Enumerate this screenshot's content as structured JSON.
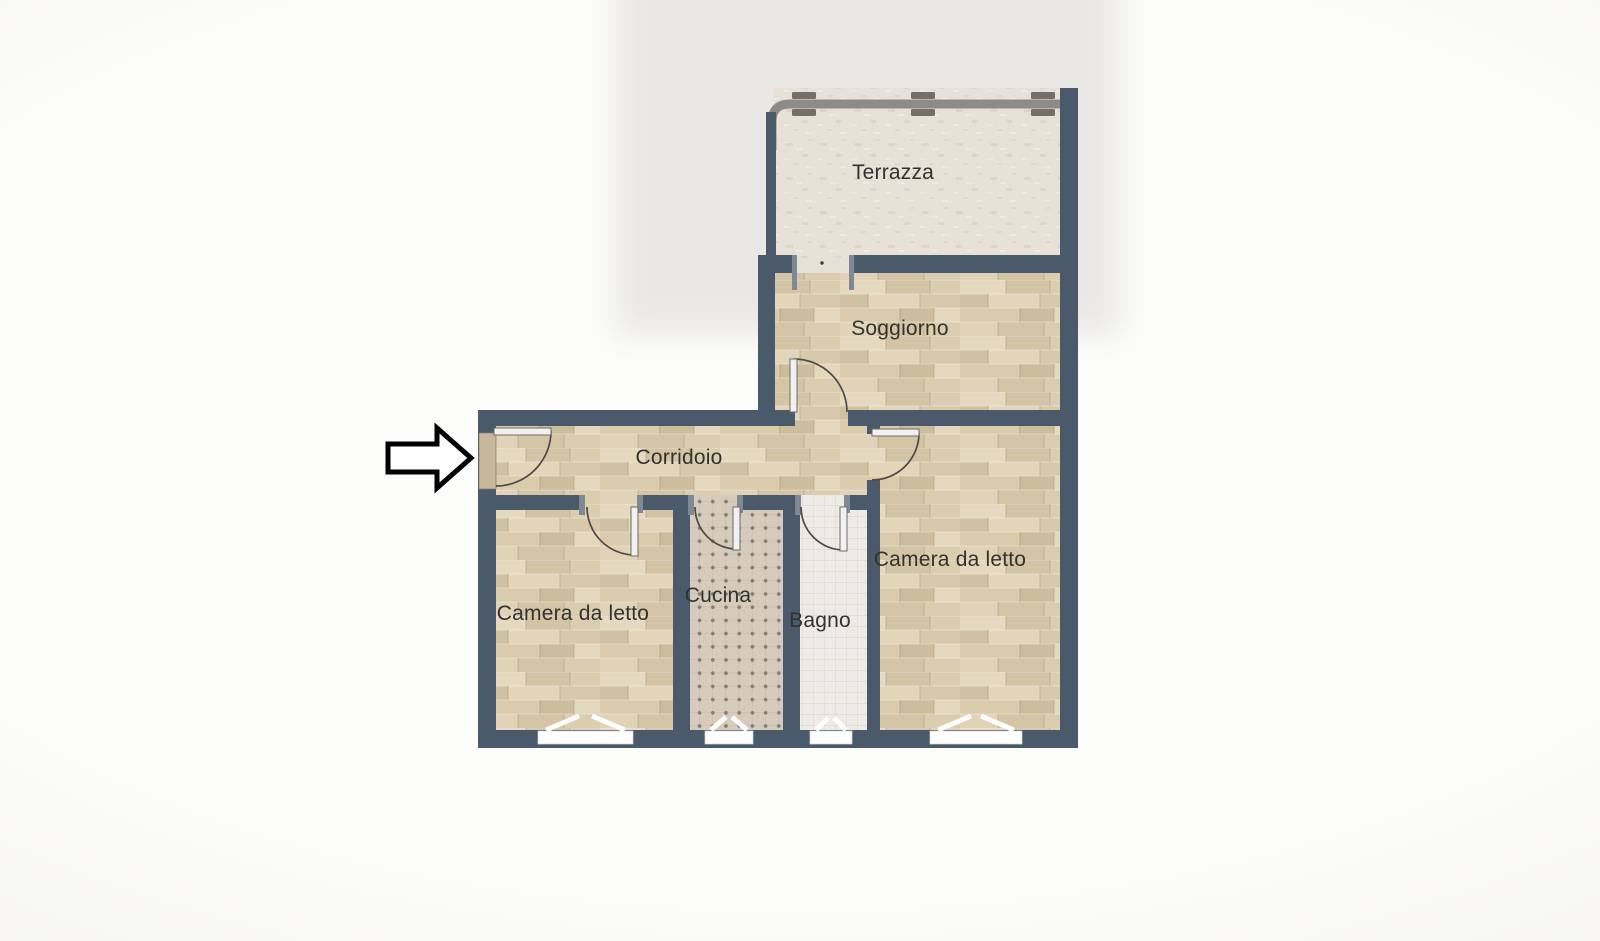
{
  "floorplan": {
    "title": "apartment-floor-plan",
    "rooms": {
      "terrazza": {
        "label": "Terrazza"
      },
      "soggiorno": {
        "label": "Soggiorno"
      },
      "corridoio": {
        "label": "Corridoio"
      },
      "camera_da_letto_sinistra": {
        "label": "Camera da letto"
      },
      "cucina": {
        "label": "Cucina"
      },
      "bagno": {
        "label": "Bagno"
      },
      "camera_da_letto_destra": {
        "label": "Camera da letto"
      }
    },
    "colors": {
      "wall": "#4b5a6b",
      "wood": "#dccfb2",
      "kitchen_tile": "#d6cbbc",
      "kitchen_dot": "#877b6e",
      "bath_tile": "#eeebe7",
      "terrace": "#e7e1d8",
      "railing": "#8d8b86",
      "railing_clamp": "#756f66",
      "label": "#32322e",
      "door_leaf": "#f2f1ef",
      "window": "#ffffff",
      "arrow_fill": "#ffffff",
      "arrow_outline": "#000000",
      "entrance_panel": "#c8b89b"
    }
  }
}
